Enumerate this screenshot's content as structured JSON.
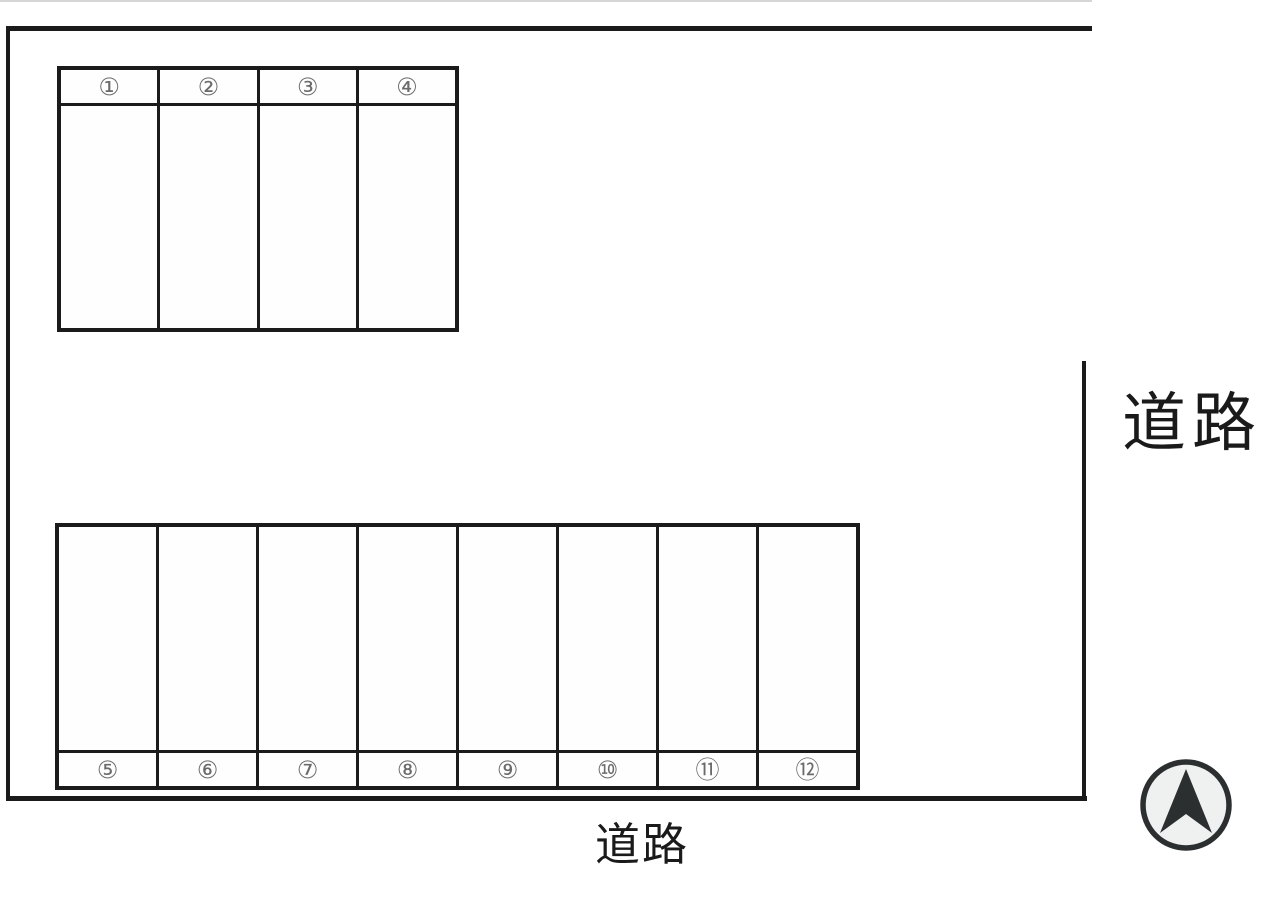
{
  "diagram": {
    "type": "parking-lot-layout",
    "road_labels": {
      "right": "道路",
      "bottom": "道路"
    },
    "top_block": {
      "position": "upper-left",
      "number_row": "top",
      "spaces": [
        "①",
        "②",
        "③",
        "④"
      ]
    },
    "bottom_block": {
      "position": "lower",
      "number_row": "bottom",
      "spaces": [
        "⑤",
        "⑥",
        "⑦",
        "⑧",
        "⑨",
        "⑩",
        "⑪",
        "⑫"
      ]
    },
    "compass": {
      "icon": "north-arrow",
      "direction": "up"
    },
    "colors": {
      "line": "#1b1b1b",
      "space_number": "#6b6b6b",
      "compass_stroke": "#2c2f30",
      "compass_fill": "#eef1f0",
      "background": "#ffffff"
    }
  }
}
